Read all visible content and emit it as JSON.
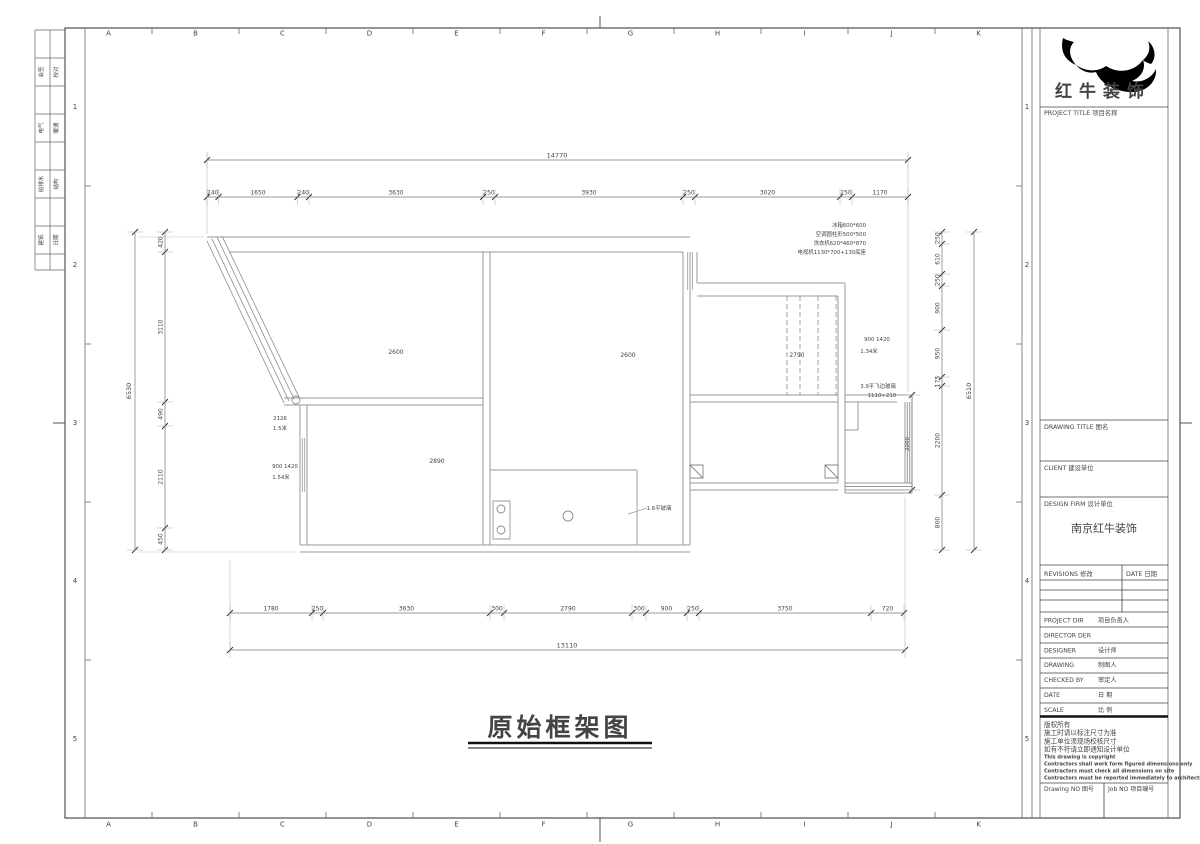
{
  "sheet": {
    "main_title": "原始框架图",
    "ruler_letters": [
      "A",
      "B",
      "C",
      "D",
      "E",
      "F",
      "G",
      "H",
      "I",
      "J",
      "K"
    ],
    "ruler_numbers": [
      "1",
      "2",
      "3",
      "4",
      "5"
    ],
    "signature_strip_rows": [
      [
        "会签",
        "校对"
      ],
      [
        "电气",
        "暖通"
      ],
      [
        "给排水",
        "结构"
      ],
      [
        "建筑",
        "日期"
      ]
    ]
  },
  "plan": {
    "dim_top_total": "14770",
    "dim_top_segments": [
      "240",
      "1650",
      "240",
      "3630",
      "250",
      "3930",
      "250",
      "3020",
      "250",
      "1170"
    ],
    "dim_bottom_total": "13110",
    "dim_bottom_segments": [
      "1780",
      "250",
      "3630",
      "300",
      "2790",
      "300",
      "900",
      "250",
      "3750",
      "720"
    ],
    "dim_left_total": "6530",
    "dim_left_segments": [
      "420",
      "3110",
      "490",
      "2110",
      "450"
    ],
    "dim_right_total": "6510",
    "dim_right_segments": [
      "250",
      "610",
      "250",
      "900",
      "950",
      "175",
      "2200",
      "800"
    ],
    "dim_right_inner": "2200",
    "room_labels": [
      {
        "t": "2600",
        "x": 396,
        "y": 354
      },
      {
        "t": "2600",
        "x": 628,
        "y": 357
      },
      {
        "t": "2790",
        "x": 797,
        "y": 357
      },
      {
        "t": "2890",
        "x": 437,
        "y": 463
      }
    ],
    "notes": [
      {
        "t": "冰箱600*600",
        "x": 866,
        "y": 227,
        "a": "end"
      },
      {
        "t": "空调圆柱形500*500",
        "x": 866,
        "y": 236,
        "a": "end"
      },
      {
        "t": "洗衣机620*460*870",
        "x": 866,
        "y": 245,
        "a": "end"
      },
      {
        "t": "电视机1130*700+130底座",
        "x": 866,
        "y": 254,
        "a": "end"
      },
      {
        "t": "2126",
        "x": 280,
        "y": 420
      },
      {
        "t": "1.5米",
        "x": 280,
        "y": 430
      },
      {
        "t": "900 1420",
        "x": 285,
        "y": 468
      },
      {
        "t": "1.54米",
        "x": 281,
        "y": 479
      },
      {
        "t": "900 1420",
        "x": 877,
        "y": 341
      },
      {
        "t": "1.34米",
        "x": 869,
        "y": 353
      },
      {
        "t": "3.9平飞边玻璃",
        "x": 878,
        "y": 388
      },
      {
        "t": "1110+210",
        "x": 882,
        "y": 397
      },
      {
        "t": "1.6平玻璃",
        "x": 659,
        "y": 510
      }
    ]
  },
  "titleblock": {
    "company_name": "红牛装饰",
    "project_title_label": "PROJECT TITLE 项目名称",
    "drawing_title_label": "DRAWING TITLE 图名",
    "client_label": "CLIENT 建设单位",
    "design_firm_label": "DESIGN FIRM 设计单位",
    "design_firm_value": "南京红牛装饰",
    "revisions_label": "REVISIONS 修改",
    "date_header_label": "DATE 日期",
    "info_rows": [
      {
        "en": "PROJECT DIR",
        "cn": "项目负责人"
      },
      {
        "en": "DIRECTOR DER",
        "cn": ""
      },
      {
        "en": "DESIGNER",
        "cn": "设计师"
      },
      {
        "en": "DRAWING",
        "cn": "制图人"
      },
      {
        "en": "CHECKED BY",
        "cn": "审定人"
      },
      {
        "en": "DATE",
        "cn": "日  期"
      },
      {
        "en": "SCALE",
        "cn": "比  例"
      }
    ],
    "copyright_cn": [
      "版权所有",
      "施工时请以标注尺寸为准",
      "施工单位须现场校核尺寸",
      "如有不符请立即通知设计单位"
    ],
    "copyright_en": [
      "This drawing is copyright",
      "Contractors shall work form figured dimensions only",
      "Contractors must check all dimensions on site",
      "Contractors must be reported immediately to architects"
    ],
    "drawing_no_label": "Drawing NO 图号",
    "job_no_label": "Job NO 项目编号"
  }
}
